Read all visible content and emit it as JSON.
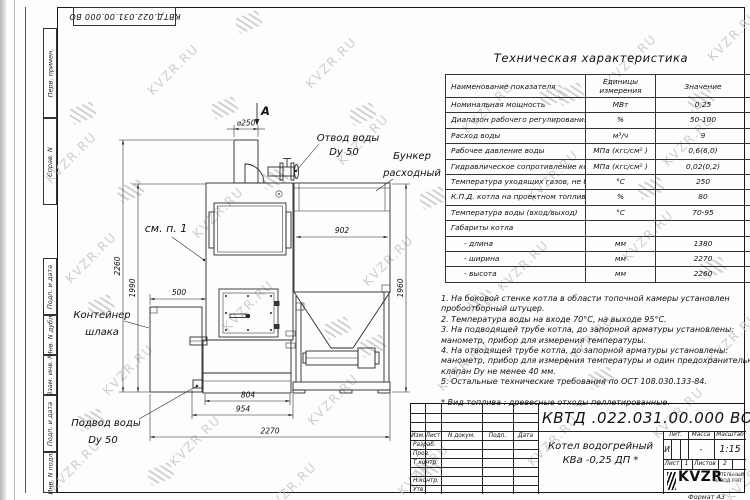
{
  "stamp_top": "КВТД.022.031.00.000 ВО",
  "watermark": {
    "text": "KVZR.RU",
    "text_positions": [
      [
        38,
        150
      ],
      [
        140,
        62
      ],
      [
        298,
        55
      ],
      [
        455,
        100
      ],
      [
        598,
        52
      ],
      [
        700,
        28
      ],
      [
        58,
        250
      ],
      [
        185,
        205
      ],
      [
        330,
        132
      ],
      [
        520,
        168
      ],
      [
        655,
        133
      ],
      [
        95,
        362
      ],
      [
        215,
        298
      ],
      [
        355,
        253
      ],
      [
        490,
        258
      ],
      [
        615,
        228
      ],
      [
        700,
        330
      ],
      [
        42,
        458
      ],
      [
        162,
        433
      ],
      [
        300,
        392
      ],
      [
        430,
        358
      ],
      [
        555,
        333
      ],
      [
        645,
        405
      ],
      [
        258,
        480
      ],
      [
        390,
        462
      ],
      [
        520,
        433
      ],
      [
        718,
        468
      ]
    ],
    "spring_positions": [
      [
        236,
        14
      ],
      [
        70,
        105
      ],
      [
        212,
        100
      ],
      [
        350,
        106
      ],
      [
        558,
        86
      ],
      [
        688,
        92
      ],
      [
        118,
        183
      ],
      [
        262,
        170
      ],
      [
        420,
        190
      ],
      [
        638,
        180
      ],
      [
        88,
        298
      ],
      [
        325,
        320
      ],
      [
        468,
        293
      ],
      [
        700,
        260
      ],
      [
        148,
        466
      ],
      [
        415,
        460
      ],
      [
        588,
        370
      ],
      [
        78,
        412
      ],
      [
        540,
        88
      ],
      [
        360,
        338
      ]
    ]
  },
  "margin_columns": [
    "Перв. примен.",
    "Справ. N",
    "Подп. и дата",
    "Инв. N дубл.",
    "Взам. инв. N",
    "Подп. и дата",
    "Инв. N подл."
  ],
  "drawing": {
    "view_label": "А",
    "dims": {
      "flue": "⌀250",
      "bunker_width": "902",
      "bunker_height": "1960",
      "total_height": "2260",
      "boiler_height": "1990",
      "container_offset": "500",
      "base_length": "804",
      "base_full": "954",
      "total_width": "2270"
    },
    "callouts": {
      "outlet1": "Отвод воды",
      "outlet2": "Dy 50",
      "bunker1": "Бункер",
      "bunker2": "расходный",
      "see_note": "см. п. 1",
      "container1": "Контейнер",
      "container2": "шлака",
      "inlet1": "Подвод воды",
      "inlet2": "Dy 50"
    }
  },
  "table": {
    "title": "Техническая характеристика",
    "headers": {
      "name": "Наименование показателя",
      "units_line1": "Единицы",
      "units_line2": "измерения",
      "value": "Значение"
    },
    "rows": [
      [
        "Номинальная мощность",
        "МВт",
        "0,25"
      ],
      [
        "Диапазон рабочего регулирования",
        "%",
        "50-100"
      ],
      [
        "Расход воды",
        "м³/ч",
        "9"
      ],
      [
        "Рабочее давление воды",
        "МПа (кгс/см² )",
        "0,6(6,0)"
      ],
      [
        "Гидравлическое сопротивление котла",
        "МПа (кгс/см² )",
        "0,02(0,2)"
      ],
      [
        "Температура уходящих газов, не более",
        "°С",
        "250"
      ],
      [
        "К.П.Д. котла на проектном топливе",
        "%",
        "80"
      ],
      [
        "Температура воды (вход/выход)",
        "°С",
        "70-95"
      ],
      [
        "Габариты котла",
        "",
        ""
      ],
      [
        "- длина",
        "мм",
        "1380"
      ],
      [
        "- ширина",
        "мм",
        "2270"
      ],
      [
        "- высота",
        "мм",
        "2260"
      ]
    ]
  },
  "notes": {
    "lines": [
      "1. На боковой стенке котла в области топочной камеры установлен",
      "пробоотборный штуцер.",
      "2. Температура воды на входе 70°С, на выходе 95°С.",
      "3. На подводящей трубе котла, до запорной арматуры установлены:",
      "манометр, прибор для измерения температуры.",
      "4. На отводящей трубе котла, до запорной арматуры установлены:",
      "манометр, прибор для измерения температуры и один предохранительный",
      "клапан Dу не менее 40 мм.",
      "5. Остальные технические требования по ОСТ 108.030.133-84.",
      "",
      "* Вид топлива : древесные отходы пеллетированные."
    ]
  },
  "title_block": {
    "designation": "КВТД .022.031.00.000 ВО",
    "product_line1": "Котел водогрейный",
    "product_line2": "КВа -0,25  ДП *",
    "headers": {
      "izm": "Изм.",
      "list": "Лист",
      "ndoc": "N докум.",
      "podp": "Подп.",
      "data": "Дата"
    },
    "roles": [
      "Разраб.",
      "Пров.",
      "Т.контр.",
      "",
      "Н.контр.",
      "Утв."
    ],
    "lit_header": "Лит.",
    "mass_header": "Масса",
    "scale_header": "Масштаб",
    "lit_value": "И",
    "mass_value": "-",
    "scale_value": "1:15",
    "sheet_label": "Лист",
    "sheet_num": "1",
    "sheets_label": "Листов",
    "sheets_num": "2",
    "logo_text": "KVZR",
    "org_line1": "КОТЕЛЬНЫЙ",
    "org_line2": "ЗАВОД РЭП",
    "format": "Формат А3"
  }
}
